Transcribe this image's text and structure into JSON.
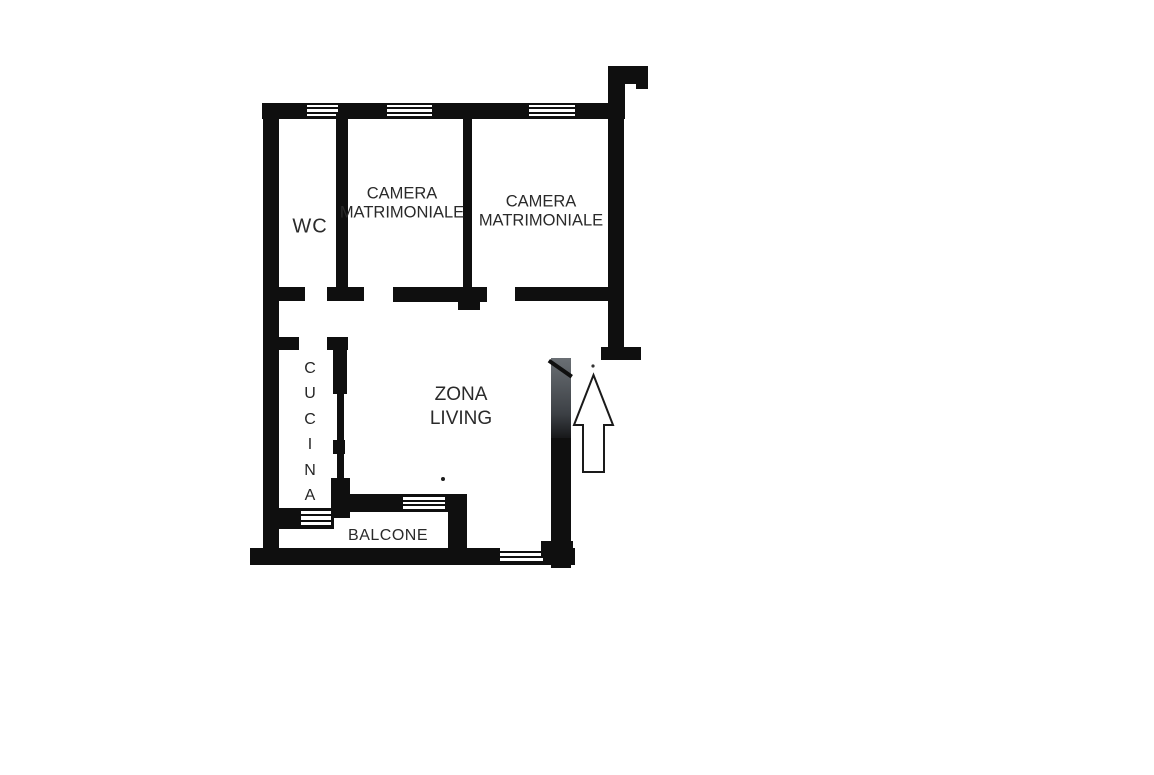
{
  "title": "Planimetria appartamento",
  "colors": {
    "wall": "#0f0f0f",
    "text": "#2a2a2a",
    "door_gray": "#3c4045",
    "background": "#ffffff"
  },
  "rooms": {
    "wc": {
      "label": "WC"
    },
    "camera1": {
      "line1": "CAMERA",
      "line2": "MATRIMONIALE"
    },
    "camera2": {
      "line1": "CAMERA",
      "line2": "MATRIMONIALE"
    },
    "zona_living": {
      "line1": "ZONA",
      "line2": "LIVING"
    },
    "cucina": {
      "letters": [
        "C",
        "U",
        "C",
        "I",
        "N",
        "A"
      ]
    },
    "balcone": {
      "label": "BALCONE"
    }
  },
  "icons": {
    "entrance_arrow": "up-arrow"
  }
}
